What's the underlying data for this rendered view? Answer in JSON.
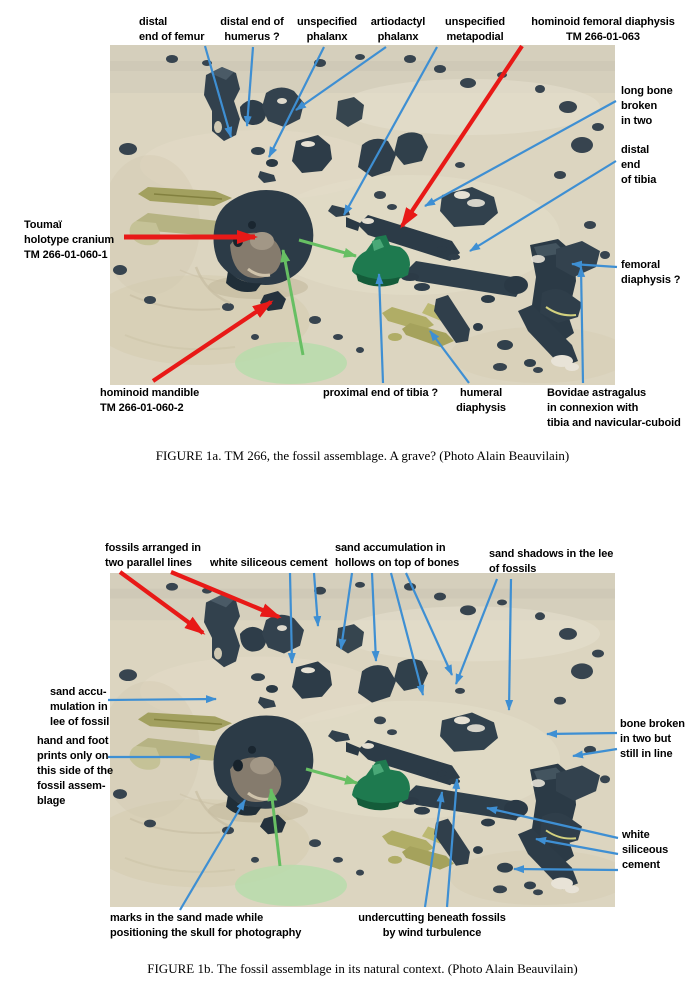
{
  "figure_1a": {
    "caption": "FIGURE 1a. TM 266, the fossil assemblage. A grave? (Photo Alain Beauvilain)",
    "labels": {
      "distal_femur": "distal\nend of femur",
      "distal_humerus": "distal end of\nhumerus ?",
      "unspecified_phalanx": "unspecified\nphalanx",
      "artiodactyl_phalanx": "artiodactyl\nphalanx",
      "unspecified_metapodial": "unspecified\nmetapodial",
      "hominoid_femoral_diaphysis": "hominoid femoral diaphysis\nTM 266-01-063",
      "long_bone_broken": "long bone\nbroken\nin two",
      "distal_end_of_tibia": "distal\nend\nof tibia",
      "femoral_diaphysis": "femoral\ndiaphysis ?",
      "toumai_cranium": "Toumaï\nholotype cranium\nTM 266-01-060-1",
      "hominoid_mandible": "hominoid mandible\nTM 266-01-060-2",
      "proximal_tibia": "proximal end of tibia ?",
      "humeral_diaphysis": "humeral\ndiaphysis",
      "bovidae_astragalus": "Bovidae astragalus\nin connexion with\ntibia and navicular-cuboid"
    }
  },
  "figure_1b": {
    "caption": "FIGURE 1b. The fossil assemblage in its natural context. (Photo Alain Beauvilain)",
    "labels": {
      "fossils_two_lines": "fossils arranged in\ntwo parallel lines",
      "white_siliceous_cement_top": "white siliceous cement",
      "sand_accumulation_hollows": "sand accumulation in\nhollows on top of bones",
      "sand_shadows": "sand shadows in the lee\nof fossils",
      "sand_accumulation_lee": "sand accu-\nmulation in\nlee of fossil",
      "hand_foot_prints": "hand and foot\nprints only on\nthis side of the\nfossil assem-\nblage",
      "bone_broken_in_line": "bone broken\nin two but\nstill in line",
      "white_siliceous_cement_right": "white\nsiliceous\ncement",
      "marks_in_sand": "marks in the sand made while\npositioning the skull for photography",
      "undercutting": "undercutting beneath fossils\nby wind turbulence"
    }
  },
  "colors": {
    "arrow_blue": "#3e8fd3",
    "arrow_red": "#e81917",
    "arrow_green": "#67bf63",
    "sand": "#dcd5c0",
    "fossil": "#2e3d49",
    "green_marker": "#1e7a4f",
    "survey_ellipse": "#b5dcaa"
  }
}
